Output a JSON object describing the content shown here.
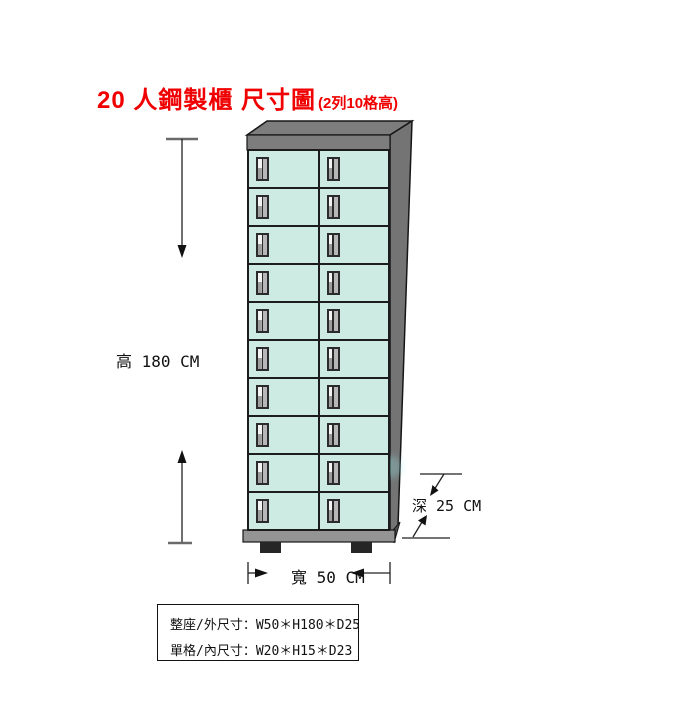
{
  "title": {
    "main": "20 人鋼製櫃 尺寸圖",
    "sub": "(2列10格高)",
    "color": "#f00000"
  },
  "cabinet": {
    "rows": 10,
    "cols": 2,
    "door_color": "#cdebe3",
    "frame_color": "#7d7d7d",
    "side_color": "#747474",
    "base_color": "#949494",
    "outline_color": "#1c1c1c",
    "feet_color": "#262626"
  },
  "dimensions": {
    "height_label": "高 180 CM",
    "width_label": "寬 50 CM",
    "depth_label": "深 25 CM"
  },
  "spec_table": {
    "rows": [
      "整座/外尺寸：W50＊H180＊D25",
      "單格/內尺寸：W20＊H15＊D23"
    ]
  }
}
